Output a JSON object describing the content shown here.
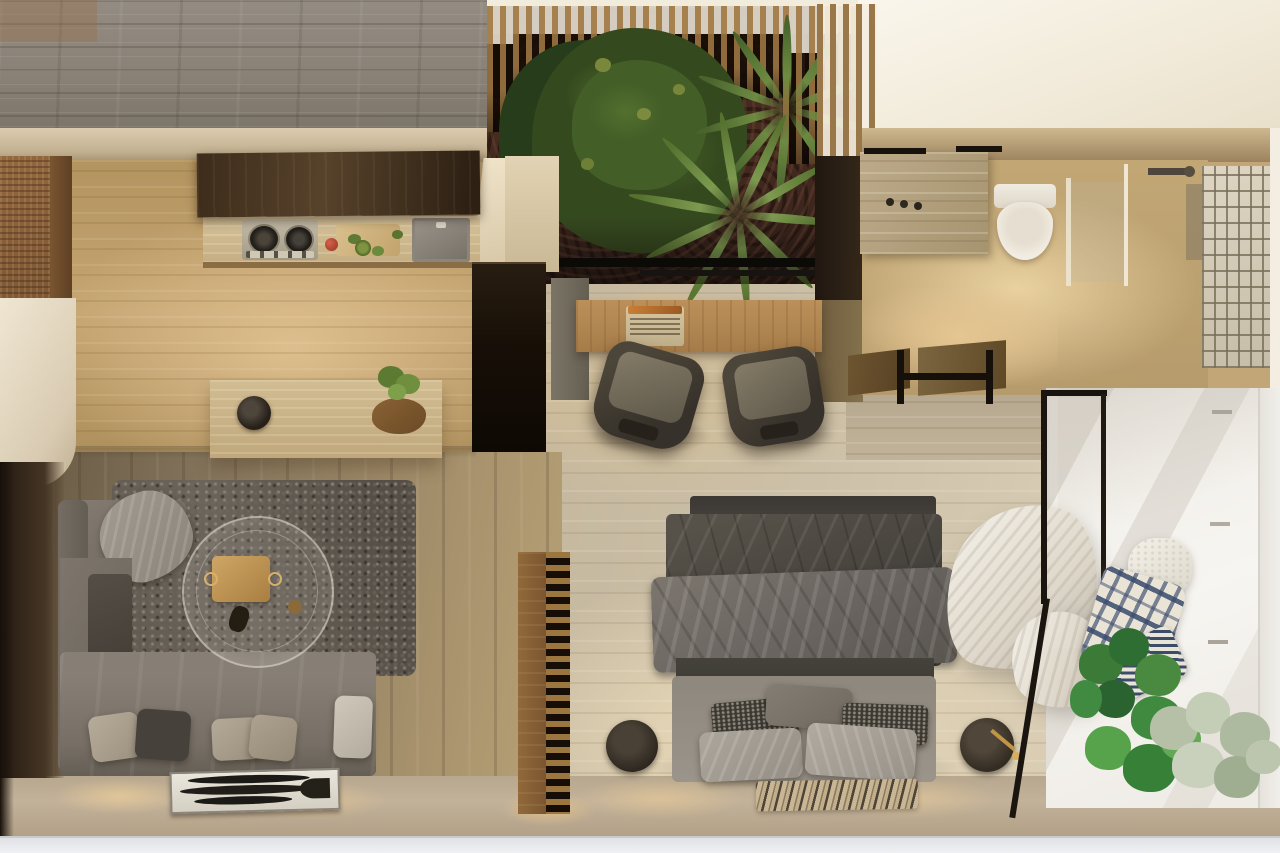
{
  "meta": {
    "type": "photorealistic-3d-render",
    "view": "top-down-floor-plan",
    "subject": "compact studio apartment interior at dusk"
  },
  "palette": {
    "gray_wood_deck": "#8e867c",
    "kitchen_travertine": "#c3a06f",
    "bedroom_travertine": "#cdc1a9",
    "living_wood": "#9c8a6d",
    "walnut_cabinet": "#4a3522",
    "courtyard_soil": "#39241c",
    "foliage_green": "#3d5926",
    "sofa_gray": "#7d756b",
    "bed_duvet": "#4e4a45",
    "balcony_white": "#f4f2ee",
    "accent_brass": "#b9904e",
    "navy_textile": "#3c4c68"
  },
  "rooms": [
    {
      "name": "kitchen",
      "objects": [
        "range-hood",
        "gas-cooktop",
        "prep-counter",
        "sink",
        "island-counter",
        "fruit-bowl",
        "potted-herb",
        "tall-dark-cabinet",
        "rattan-cabinet"
      ]
    },
    {
      "name": "courtyard",
      "objects": [
        "pergola-slats",
        "tree-canopy",
        "palm-plants",
        "soil-bed",
        "window-frame"
      ]
    },
    {
      "name": "bathroom",
      "objects": [
        "travertine-vanity",
        "faucet",
        "toilet",
        "shower-glass-partition",
        "shower-fixture",
        "glass-block-wall",
        "wood-bench"
      ]
    },
    {
      "name": "office-nook",
      "objects": [
        "oak-desk",
        "laptop",
        "desk-chair-left",
        "desk-chair-right"
      ]
    },
    {
      "name": "living-room",
      "objects": [
        "l-shaped-sofa",
        "throw-blanket",
        "sofa-pillows",
        "shag-rug",
        "round-glass-coffee-table",
        "brass-tray",
        "leaning-artwork",
        "slatted-room-divider"
      ]
    },
    {
      "name": "bedroom",
      "objects": [
        "double-bed",
        "dark-duvet",
        "folded-blanket",
        "bed-pillows",
        "bedside-pouf-left",
        "bedside-pouf-right-with-lamp",
        "patterned-runner-rug",
        "sheer-curtain",
        "glass-pivot-door"
      ]
    },
    {
      "name": "balcony",
      "objects": [
        "hanging-chair",
        "knit-cushion",
        "plaid-blanket",
        "striped-pillow",
        "monstera-plant",
        "pale-fiddle-plant",
        "sunlit-white-wall"
      ]
    }
  ]
}
